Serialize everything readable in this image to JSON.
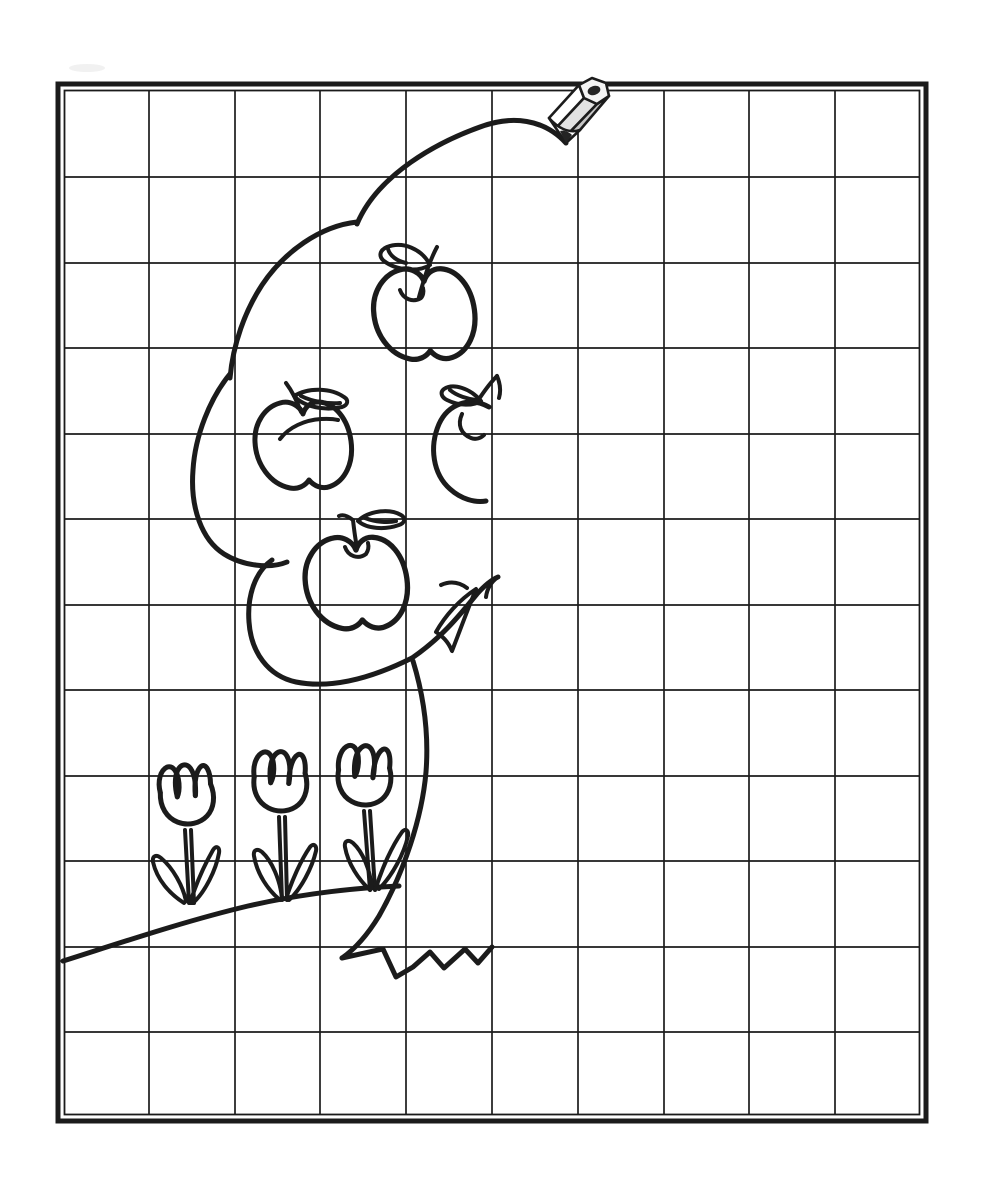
{
  "worksheet": {
    "aria_label": "Grid copy drawing worksheet: left half of a smiling apple tree with apples and tulips, to be mirrored by following the grid; a pencil rests where the line ends",
    "kind": "complete-the-drawing grid worksheet",
    "grid": {
      "columns": 10,
      "rows": 12,
      "cell_size_px": 86,
      "mirror_axis_column_index": 5
    },
    "drawing": {
      "subject": "apple tree (left half drawn)",
      "apples_count": 4,
      "tulips_count": 3,
      "elements": [
        "tree-canopy-left-half",
        "apple-top",
        "apple-left",
        "apple-half-on-axis",
        "apple-bottom",
        "canopy-end-leaf",
        "trunk-left-edge",
        "trunk-zigzag-base",
        "ground-hill-line",
        "tulip-1",
        "tulip-2",
        "tulip-3",
        "pencil"
      ]
    },
    "colors": {
      "background": "#ffffff",
      "line": "#1b1b1b",
      "grid_line": "#1c1c1c",
      "pencil_body_light": "#ffffff",
      "pencil_body_mid": "#e2e2e2",
      "pencil_body_dark": "#c6c6c6",
      "pencil_lead": "#242424"
    }
  }
}
